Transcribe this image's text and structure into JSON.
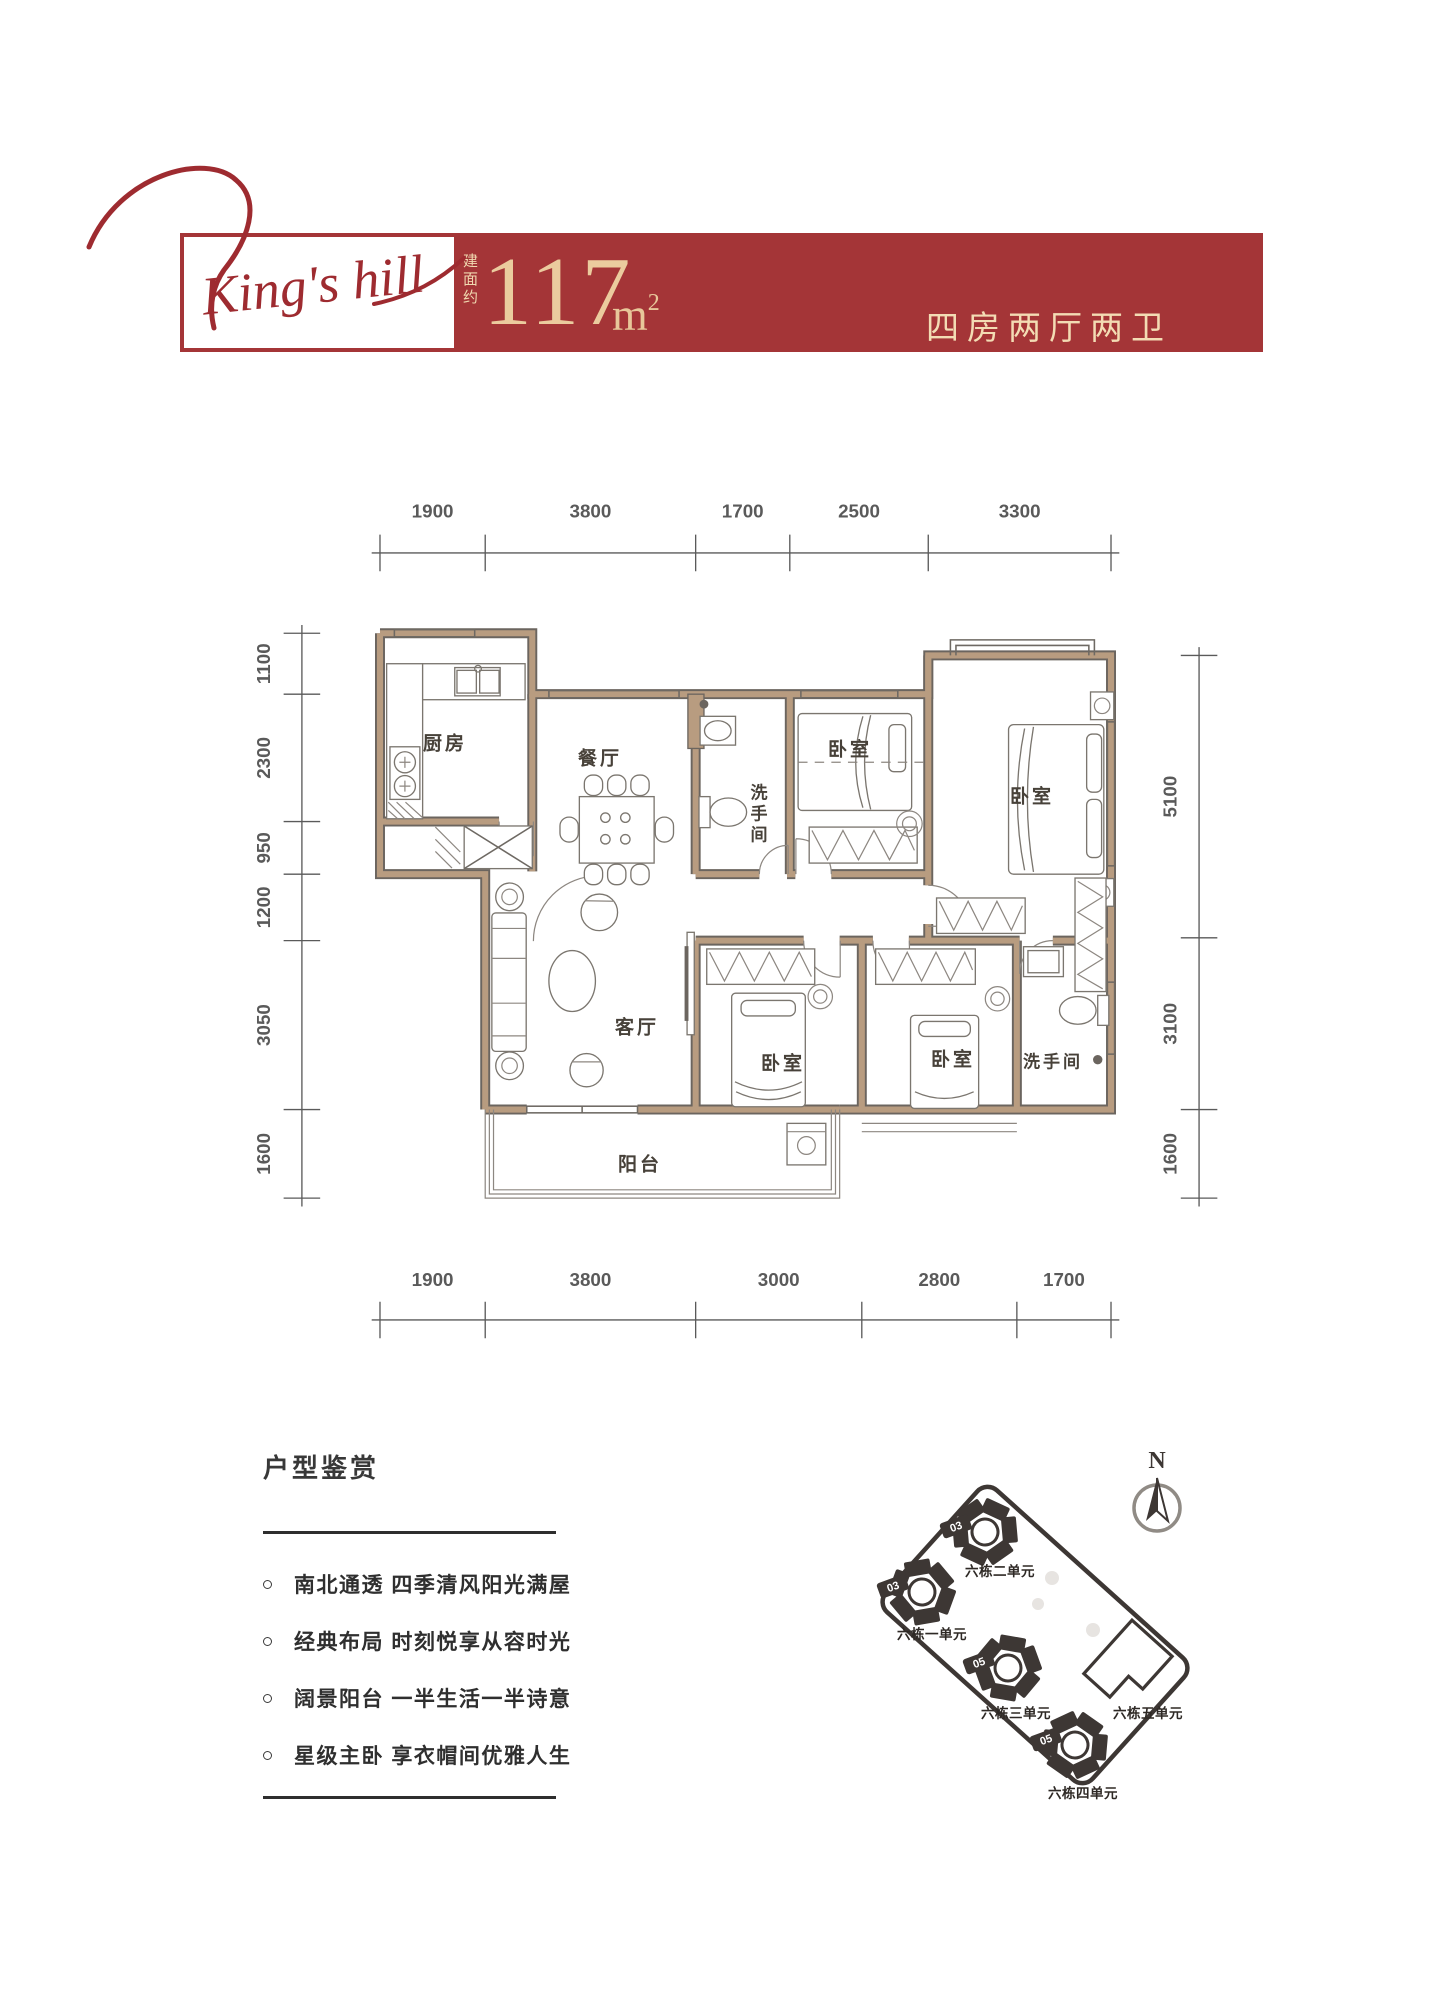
{
  "header": {
    "logo_text": "King's hill",
    "area_label_vertical": "建面约",
    "area_value": "117",
    "area_unit_base": "m",
    "area_unit_sup": "2",
    "type_label": "四房两厅两卫"
  },
  "floorplan": {
    "dims": {
      "top": [
        "1900",
        "3800",
        "1700",
        "2500",
        "3300"
      ],
      "bottom": [
        "1900",
        "3800",
        "3000",
        "2800",
        "1700"
      ],
      "left": [
        "1100",
        "2300",
        "950",
        "1200",
        "3050",
        "1600"
      ],
      "right": [
        "5100",
        "3100",
        "1600"
      ]
    },
    "rooms": [
      {
        "label": "厨房"
      },
      {
        "label": "餐厅"
      },
      {
        "label": "洗手间"
      },
      {
        "label": "卧室"
      },
      {
        "label": "卧室"
      },
      {
        "label": "客厅"
      },
      {
        "label": "卧室"
      },
      {
        "label": "卧室"
      },
      {
        "label": "洗手间"
      },
      {
        "label": "阳台"
      }
    ]
  },
  "appreciation": {
    "title": "户型鉴赏",
    "bullets": [
      "南北通透 四季清风阳光满屋",
      "经典布局 时刻悦享从容时光",
      "阔景阳台 一半生活一半诗意",
      "星级主卧 享衣帽间优雅人生"
    ]
  },
  "siteplan": {
    "north_label": "N",
    "buildings": [
      {
        "name": "六栋二单元",
        "badge": "03"
      },
      {
        "name": "六栋一单元",
        "badge": "03"
      },
      {
        "name": "六栋三单元",
        "badge": "05"
      },
      {
        "name": "六栋四单元",
        "badge": "05"
      },
      {
        "name": "六栋五单元",
        "badge": ""
      }
    ]
  },
  "colors": {
    "banner_red": "#A43537",
    "logo_red": "#9E2B30",
    "gold_text": "#EBCB9E",
    "cream_text": "#F3DCB4",
    "wall_tan": "#B89C80",
    "plan_line": "#6B655F",
    "dim_gray": "#5A5A5A",
    "site_dark": "#3D3734"
  }
}
